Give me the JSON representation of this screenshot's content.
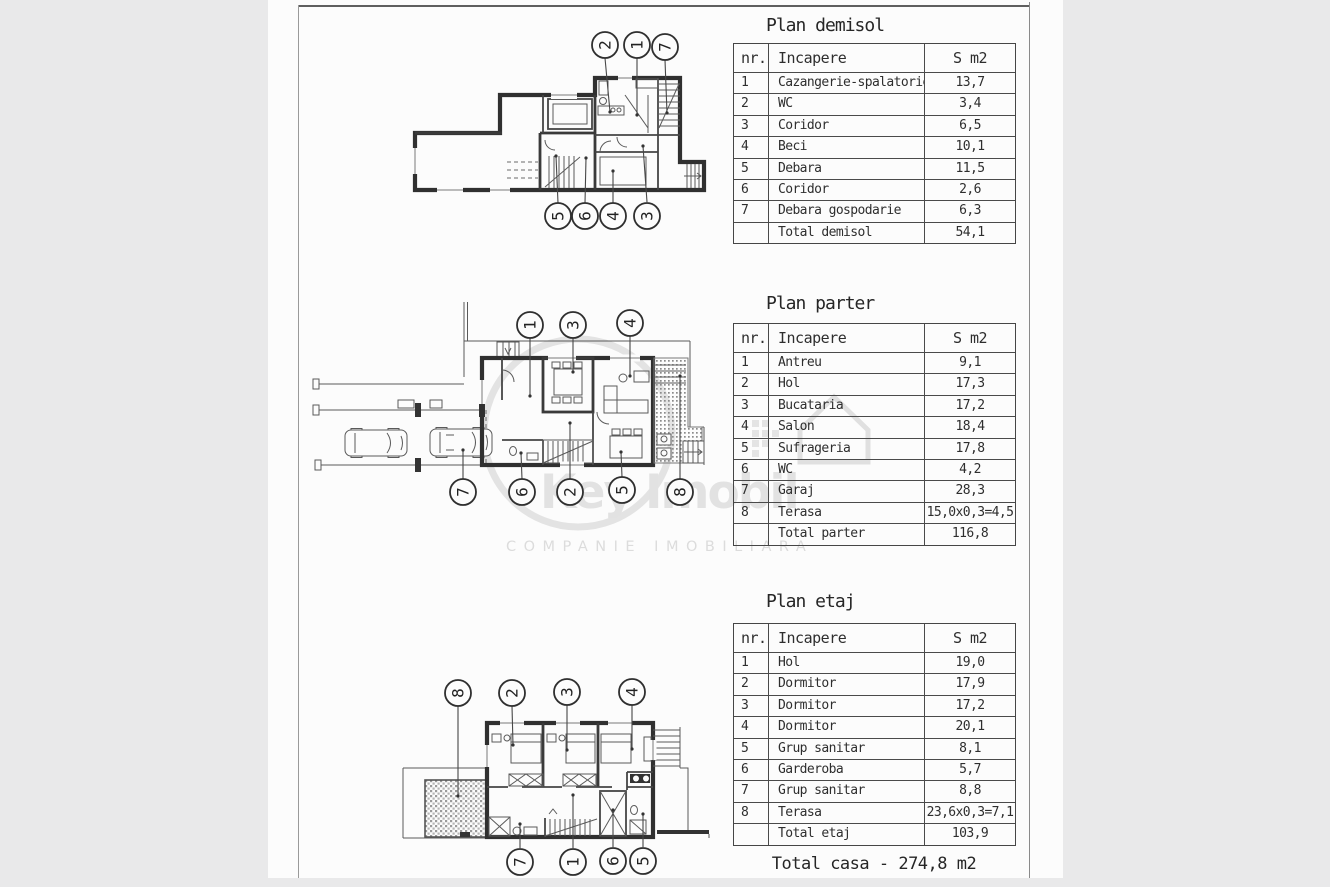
{
  "page": {
    "total_line": "Total casa - 274,8 m2"
  },
  "tables": [
    {
      "title": "Plan demisol",
      "columns": [
        "nr.",
        "Incapere",
        "S m2"
      ],
      "rows": [
        [
          "1",
          "Cazangerie-spalatorie",
          "13,7"
        ],
        [
          "2",
          "WC",
          "3,4"
        ],
        [
          "3",
          "Coridor",
          "6,5"
        ],
        [
          "4",
          "Beci",
          "10,1"
        ],
        [
          "5",
          "Debara",
          "11,5"
        ],
        [
          "6",
          "Coridor",
          "2,6"
        ],
        [
          "7",
          "Debara gospodarie",
          "6,3"
        ],
        [
          "",
          "Total demisol",
          "54,1"
        ]
      ]
    },
    {
      "title": "Plan parter",
      "columns": [
        "nr.",
        "Incapere",
        "S m2"
      ],
      "rows": [
        [
          "1",
          "Antreu",
          "9,1"
        ],
        [
          "2",
          "Hol",
          "17,3"
        ],
        [
          "3",
          "Bucataria",
          "17,2"
        ],
        [
          "4",
          "Salon",
          "18,4"
        ],
        [
          "5",
          "Sufrageria",
          "17,8"
        ],
        [
          "6",
          "WC",
          "4,2"
        ],
        [
          "7",
          "Garaj",
          "28,3"
        ],
        [
          "8",
          "Terasa",
          "15,0x0,3=4,5"
        ],
        [
          "",
          "Total parter",
          "116,8"
        ]
      ]
    },
    {
      "title": "Plan etaj",
      "columns": [
        "nr.",
        "Incapere",
        "S m2"
      ],
      "rows": [
        [
          "1",
          "Hol",
          "19,0"
        ],
        [
          "2",
          "Dormitor",
          "17,9"
        ],
        [
          "3",
          "Dormitor",
          "17,2"
        ],
        [
          "4",
          "Dormitor",
          "20,1"
        ],
        [
          "5",
          "Grup sanitar",
          "8,1"
        ],
        [
          "6",
          "Garderoba",
          "5,7"
        ],
        [
          "7",
          "Grup sanitar",
          "8,8"
        ],
        [
          "8",
          "Terasa",
          "23,6x0,3=7,1"
        ],
        [
          "",
          "Total etaj",
          "103,9"
        ]
      ]
    }
  ],
  "plans": [
    {
      "name": "demisol",
      "markers": {
        "top": [
          "2",
          "1",
          "7"
        ],
        "bottom": [
          "5",
          "6",
          "4",
          "3"
        ]
      }
    },
    {
      "name": "parter",
      "markers": {
        "top": [
          "1",
          "3",
          "4"
        ],
        "bottom": [
          "7",
          "6",
          "2",
          "5",
          "8"
        ]
      }
    },
    {
      "name": "etaj",
      "markers": {
        "top": [
          "8",
          "2",
          "3",
          "4"
        ],
        "bottom": [
          "7",
          "1",
          "6",
          "5"
        ]
      }
    }
  ],
  "watermark": {
    "brand_key": "Key",
    "brand_imobil": "Imobil",
    "tagline": "COMPANIE IMOBILIARA"
  },
  "colors": {
    "paper": "#fcfcfc",
    "margin_gray": "#e9e9ea",
    "ink": "#2e2e2e",
    "watermark_gray": "#e2e2e2"
  }
}
